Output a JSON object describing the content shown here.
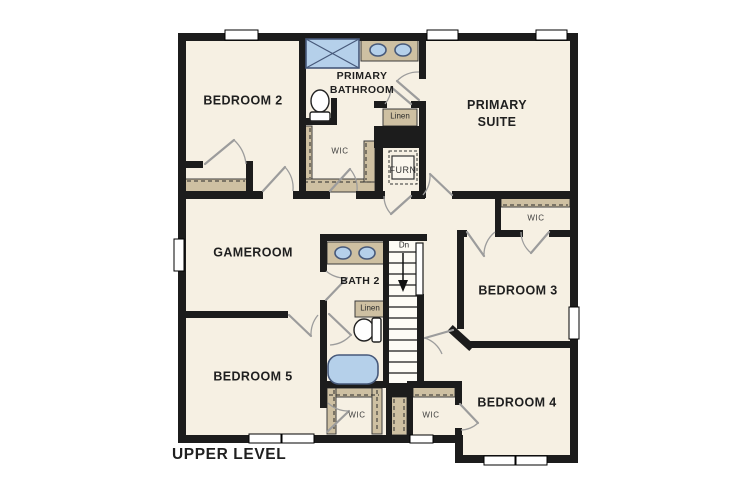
{
  "colors": {
    "wall": "#1c1c1c",
    "floor": "#f6f0e3",
    "casework": "#cec0a2",
    "fixture": "#b5d0ea",
    "fixture_border": "#47597a",
    "swing": "#9c9c9c",
    "window": "#ffffff",
    "text": "#1f1f1f"
  },
  "floorplan": {
    "level_label": "UPPER LEVEL",
    "rooms": {
      "bedroom2": "BEDROOM 2",
      "primary_bathroom": "PRIMARY BATHROOM",
      "primary_suite": "PRIMARY SUITE",
      "gameroom": "GAMEROOM",
      "bath2": "BATH 2",
      "bedroom3": "BEDROOM 3",
      "bedroom4": "BEDROOM 4",
      "bedroom5": "BEDROOM 5"
    },
    "closets": {
      "wic_primary": "WIC",
      "wic_bedroom3": "WIC",
      "wic_bedroom5": "WIC",
      "wic_bedroom4": "WIC",
      "linen_primary": "Linen",
      "linen_bath2": "Linen"
    },
    "utility": {
      "furnace": "FURN"
    },
    "stairs": {
      "down_label": "Dn",
      "direction": "down"
    },
    "fixtures": [
      "shower",
      "double-vanity-primary",
      "toilet-primary",
      "double-vanity-bath2",
      "toilet-bath2",
      "bathtub",
      "furnace-unit",
      "stairs-down"
    ]
  }
}
